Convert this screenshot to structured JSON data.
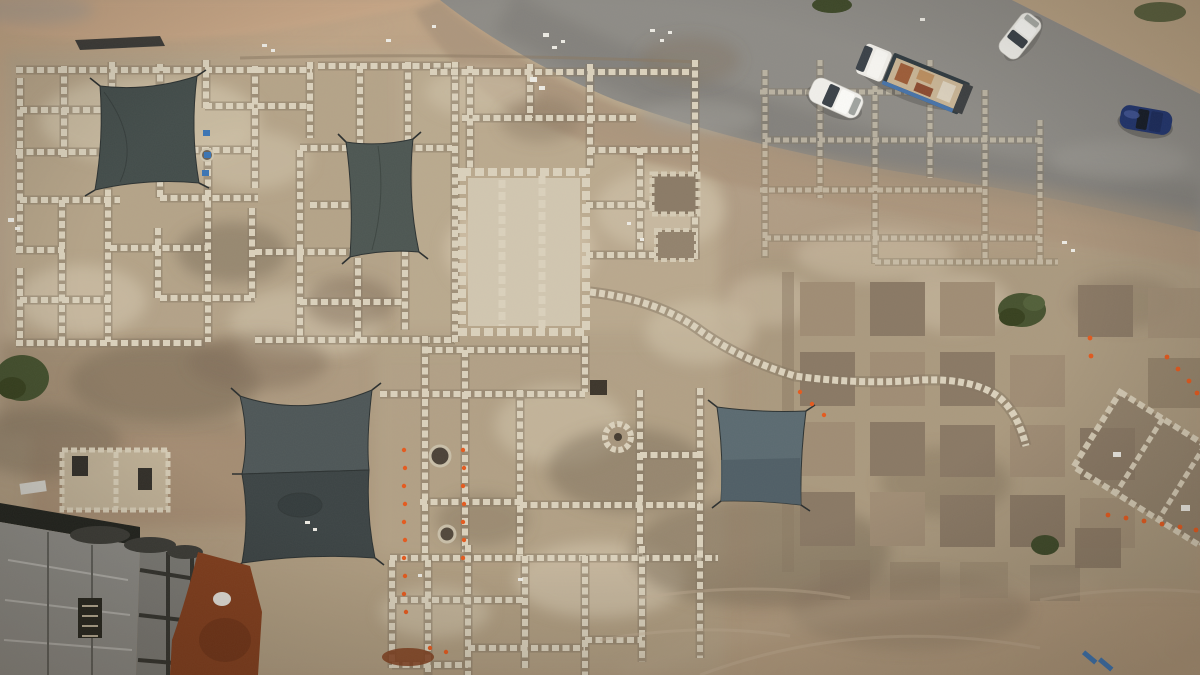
{
  "meta": {
    "title": "Aerial drone photograph of an archaeological excavation site beside a curving road",
    "type": "photograph",
    "width_px": 1200,
    "height_px": 675
  },
  "scene": {
    "site": {
      "label": "excavation-site",
      "features": [
        "stone-wall-foundations",
        "room-grid",
        "large-pillared-hall",
        "curved-apse-wall",
        "well-rings",
        "excavation-square-grid",
        "balks",
        "survey-marker-dots",
        "debris"
      ]
    },
    "road": {
      "label": "asphalt-road",
      "position": "top-right",
      "shape": "curved-band"
    },
    "vehicles": [
      {
        "id": "white-car-driving",
        "type": "car",
        "color": "#f0efeb",
        "location": "on-road"
      },
      {
        "id": "flatbed-truck",
        "type": "truck",
        "cab_color": "#efede8",
        "bed_color": "#2f3a40",
        "cargo_color": "#c7b394",
        "location": "on-road"
      },
      {
        "id": "white-car-parked",
        "type": "car",
        "color": "#efeee9",
        "location": "dirt-shoulder-top-right"
      },
      {
        "id": "blue-car",
        "type": "car",
        "color": "#21356f",
        "location": "on-road-right"
      }
    ],
    "tarps": [
      {
        "id": "tarp-northwest",
        "color": "#434d4b"
      },
      {
        "id": "tarp-north-center",
        "color": "#4d5753"
      },
      {
        "id": "tarp-southwest",
        "color": "#454d4e"
      },
      {
        "id": "tarp-center-east",
        "color": "#5b6b72"
      }
    ],
    "construction": {
      "id": "concrete-building-under-construction",
      "position": "bottom-left",
      "color": "#8c8b86"
    },
    "ground": {
      "sand": "#c6a887",
      "dirt": "#9d8971",
      "red_soil": "#833f1e"
    },
    "vegetation": {
      "bush_color": "#46522f",
      "bush_count": 5
    }
  },
  "colors": {
    "sandTop": "#c6a887",
    "pinkSand": "#c9a888",
    "road": "#8e8c87",
    "roadDark": "#74726d",
    "shoulder": "#ab947c",
    "cornerDirt": "#b7a183",
    "siteBase": "#b5a48a",
    "paleStone": "#cfc1a8",
    "stoneWall": "#dbd2bd",
    "wallShadow": "#857864",
    "hallFloor": "#d2c7b1",
    "pitDark": "#8a7965",
    "pitMid": "#a08d75",
    "trench": "#8c7a64",
    "dirtDark": "#7e6d59",
    "tarpNW": "#434d4b",
    "tarpN": "#4d5753",
    "tarpSWLight": "#4e5758",
    "tarpSWDark": "#3c4445",
    "tarpE": "#5b6b72",
    "tarpEDark": "#4d5d64",
    "concrete": "#8c8b86",
    "concreteDark": "#7c7b76",
    "beam": "#34342f",
    "redSoil": "#833f1e",
    "redSoilDark": "#6d3317",
    "orange": "#e55a1e",
    "bush": "#46522f",
    "bushDark": "#37411f",
    "white": "#edebe4",
    "blueItem": "#3a74b4",
    "carWhite": "#f0efeb",
    "carBlue": "#21356f",
    "glass": "#3a4148",
    "truckBed": "#2f3a40",
    "cargo": "#c7b394",
    "black": "#232625"
  }
}
